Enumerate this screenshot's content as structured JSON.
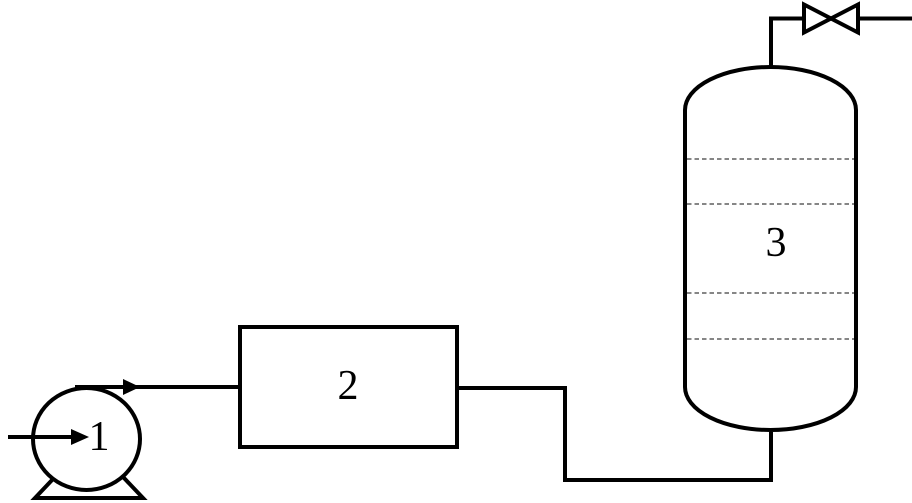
{
  "diagram": {
    "kind": "process-flow-diagram",
    "background_color": "#ffffff",
    "line_color": "#000000",
    "tray_line_color": "#3f3f3f",
    "text_color": "#000000",
    "equipment": {
      "pump": {
        "label": "1"
      },
      "box_unit": {
        "label": "2"
      },
      "column": {
        "label": "3",
        "tray_count": "4"
      }
    }
  }
}
